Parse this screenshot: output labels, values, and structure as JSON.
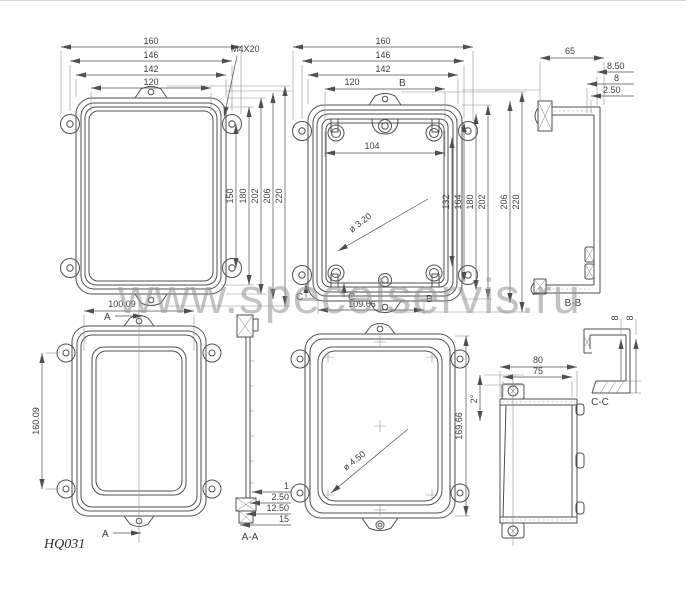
{
  "page": {
    "watermark": "www.specelservis.ru",
    "drawing_code": "HQ031"
  },
  "views": {
    "lid_front": {
      "dim_160": "160",
      "dim_146": "146",
      "dim_142": "142",
      "dim_120": "120",
      "screw_callout": "M4X20",
      "dim_150": "150",
      "dim_180": "180",
      "dim_202": "202",
      "dim_206": "206",
      "dim_220": "220"
    },
    "box_front": {
      "dim_160": "160",
      "dim_146": "146",
      "dim_142": "142",
      "dim_120": "120",
      "section_b_top": "B",
      "dim_104": "104",
      "dim_132": "132",
      "dim_164": "164",
      "dim_180": "180",
      "dim_202": "202",
      "dim_206": "206",
      "dim_220": "220",
      "hole_callout": "ø 3.20",
      "dim_109_66": "109.66",
      "section_c_left": "C",
      "section_c_right": "C",
      "section_b_bottom": "B"
    },
    "section_bb": {
      "dim_65": "65",
      "dim_8_50": "8.50",
      "dim_8": "8",
      "dim_2_50": "2.50",
      "label": "B-B"
    },
    "lid_back": {
      "dim_100_09": "100.09",
      "dim_160_09": "160.09",
      "section_a_top": "A",
      "section_a_bottom": "A"
    },
    "section_aa": {
      "dim_1": "1",
      "dim_2_50": "2.50",
      "dim_12_50": "12.50",
      "dim_15": "15",
      "label": "A-A"
    },
    "lid_inside": {
      "dim_169_66": "169.66",
      "hole_callout": "ø 4.50"
    },
    "box_side": {
      "dim_80": "80",
      "dim_75": "75",
      "draft_angle": "2°"
    },
    "section_cc": {
      "dim_8_left": "8",
      "dim_8_right": "8",
      "label": "C-C"
    }
  }
}
